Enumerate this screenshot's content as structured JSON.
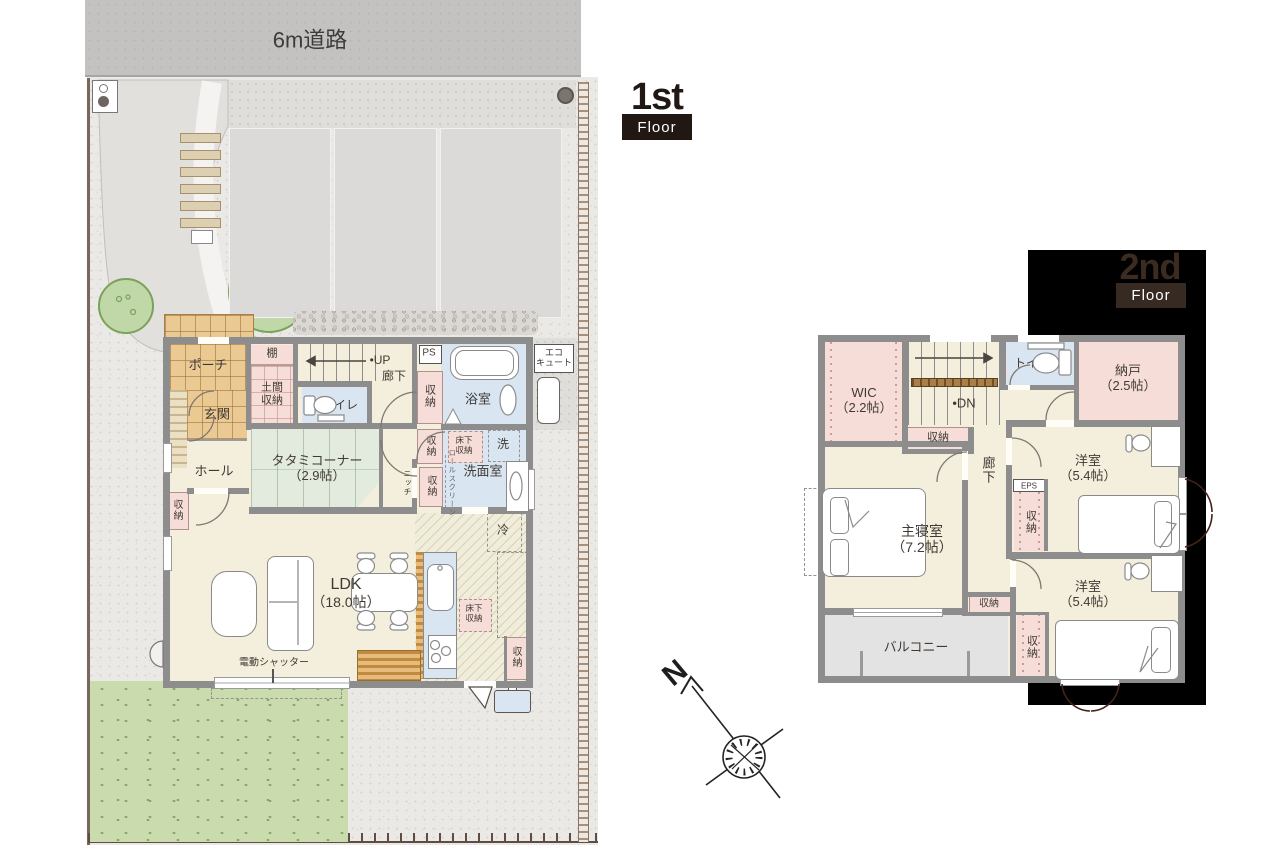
{
  "road_label": "6m道路",
  "badge1": {
    "big": "1st",
    "small": "Floor"
  },
  "badge2": {
    "big": "2nd",
    "small": "Floor"
  },
  "compass_n": "N",
  "f1": {
    "porch": "ポーチ",
    "shelf": "棚",
    "up": "•UP",
    "corridor": "廊下",
    "doma_l1": "土間",
    "doma_l2": "収納",
    "entrance": "玄関",
    "toilet": "トイレ",
    "ps": "PS",
    "bath": "浴室",
    "eco_l1": "エコ",
    "eco_l2": "キュート",
    "storage": "収納",
    "underfloor_l1": "床下",
    "underfloor_l2": "収納",
    "washer": "洗",
    "washroom": "洗面室",
    "rollscreen": "ロールスクリーン",
    "niche": "ニッチ",
    "tatami_l1": "タタミコーナー",
    "tatami_l2": "（2.9帖）",
    "hall": "ホール",
    "fridge": "冷",
    "ldk_l1": "LDK",
    "ldk_l2": "（18.0帖）",
    "shutter": "電動シャッター"
  },
  "f2": {
    "wic_l1": "WIC",
    "wic_l2": "（2.2帖）",
    "dn": "•DN",
    "toilet": "トイレ",
    "storeroom_l1": "納戸",
    "storeroom_l2": "（2.5帖）",
    "storage": "収納",
    "corridor": "廊下",
    "eps": "EPS",
    "west1_l1": "洋室",
    "west1_l2": "（5.4帖）",
    "master_l1": "主寝室",
    "master_l2": "（7.2帖）",
    "west2_l1": "洋室",
    "west2_l2": "（5.4帖）",
    "balcony": "バルコニー"
  },
  "colors": {
    "wall": "#8d8d8d",
    "floor_cream": "#f3efdc",
    "tatami_green": "#e2ebdd",
    "water_blue": "#d9e6f2",
    "storage_pink": "#f6ddd8",
    "tile_orange": "#ebc992",
    "grass_green": "#cadcae",
    "road_gray": "#c3c2c1",
    "balcony_gray": "#e4e3e3",
    "black_panel": "#000000",
    "badge_dark": "#221813"
  }
}
